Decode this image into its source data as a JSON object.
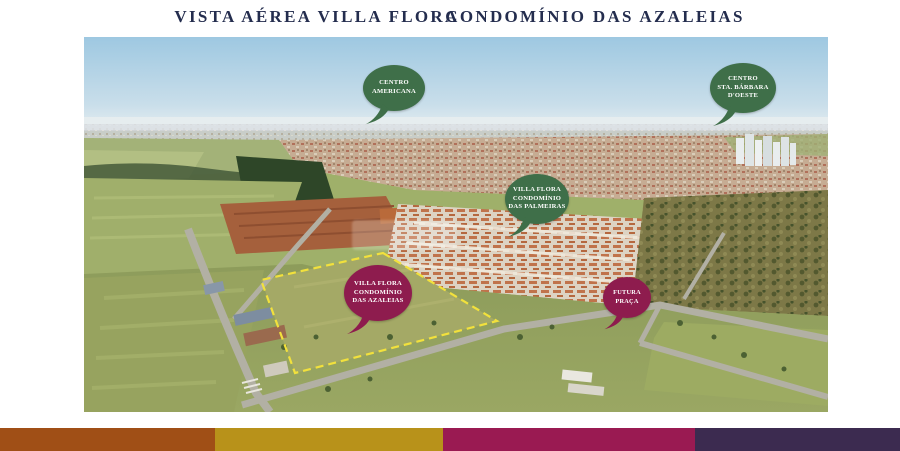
{
  "header": {
    "title_left": "VISTA AÉREA VILLA FLORA",
    "title_right": "CONDOMÍNIO DAS AZALEIAS",
    "title_color": "#242d4e"
  },
  "map": {
    "description": "Vista aérea com marcadores de localização",
    "pins": [
      {
        "name": "centro-americana",
        "label": "CENTRO\nAMERICANA",
        "color": "#3f6f49"
      },
      {
        "name": "centro-sta-barbara-doeste",
        "label": "CENTRO\nSTA. BÁRBARA\nD'OESTE",
        "color": "#3f6f49"
      },
      {
        "name": "villa-flora-condominio-das-palmeiras",
        "label": "VILLA FLORA\nCONDOMÍNIO\nDAS PALMEIRAS",
        "color": "#3f6f49"
      },
      {
        "name": "villa-flora-condominio-das-azaleias",
        "label": "VILLA FLORA\nCONDOMÍNIO\nDAS AZALEIAS",
        "color": "#8e1c4e"
      },
      {
        "name": "futura-praca",
        "label": "FUTURA\nPRAÇA",
        "color": "#8e1c4e"
      }
    ],
    "site_outline_color": "#f2e13c"
  },
  "footer": {
    "bars": [
      {
        "name": "bar-brown",
        "color": "#a04f16"
      },
      {
        "name": "bar-gold",
        "color": "#b8921a"
      },
      {
        "name": "bar-magenta",
        "color": "#9a1a52"
      },
      {
        "name": "bar-purple",
        "color": "#3c2b50"
      }
    ]
  }
}
